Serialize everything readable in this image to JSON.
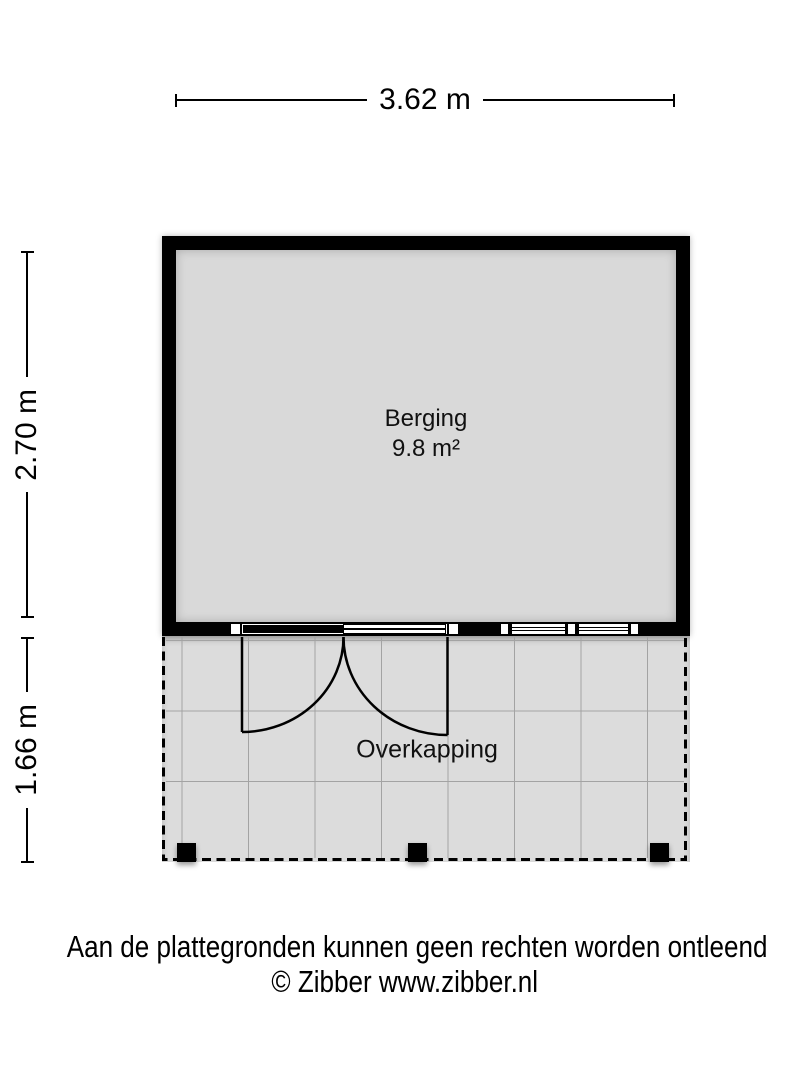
{
  "plan": {
    "room": {
      "name": "Berging",
      "area": "9.8 m²"
    },
    "canopy": {
      "name": "Overkapping"
    },
    "dimensions": {
      "width": "3.62 m",
      "room_depth": "2.70 m",
      "canopy_depth": "1.66 m"
    },
    "footer": {
      "disclaimer": "Aan de plattegronden kunnen geen rechten worden ontleend",
      "credit": "© Zibber www.zibber.nl"
    },
    "colors": {
      "wall": "#000000",
      "room_fill": "#d9d9d9",
      "canopy_fill": "#dcdcdc",
      "grid_line": "#a3a3a3",
      "background": "#ffffff"
    }
  }
}
